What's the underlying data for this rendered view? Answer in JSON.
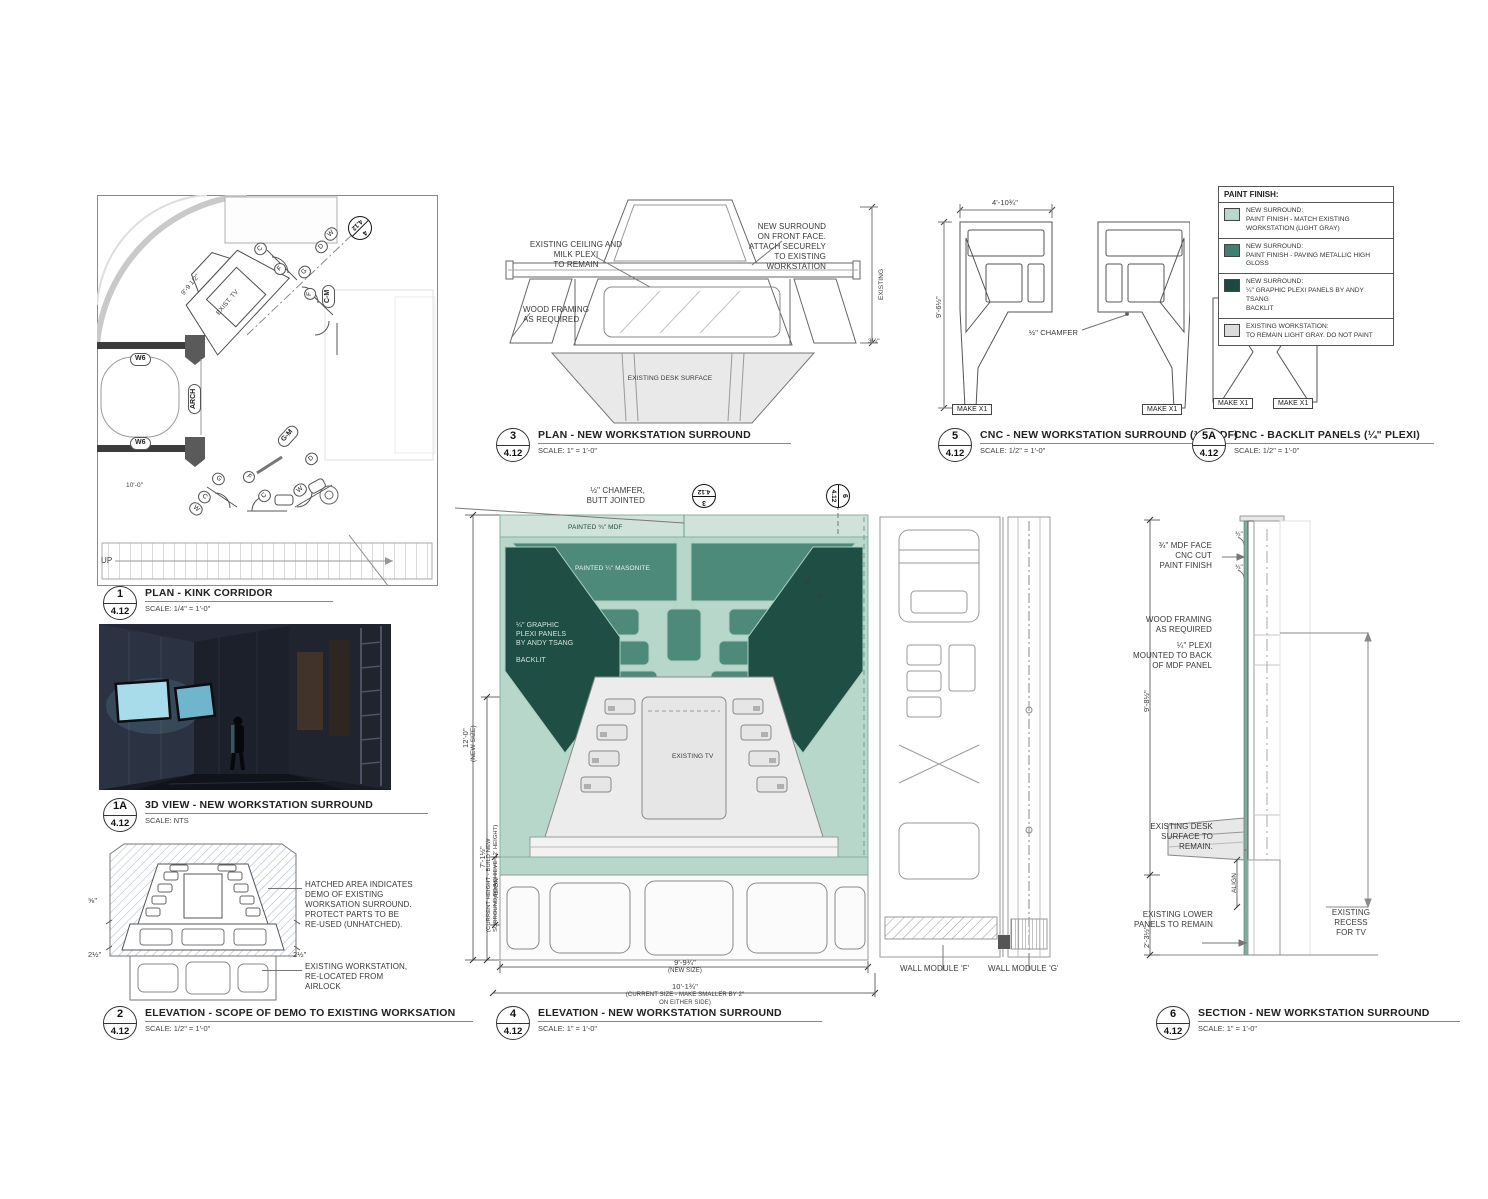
{
  "legend": {
    "title": "PAINT FINISH:",
    "items": [
      {
        "color": "#b9d8cd",
        "text": "NEW SURROUND:\nPAINT FINISH - MATCH EXISTING WORKSTATION (LIGHT GRAY)"
      },
      {
        "color": "#3f8070",
        "text": "NEW SURROUND:\nPAINT FINISH - PAVING METALLIC HIGH GLOSS"
      },
      {
        "color": "#1d4a40",
        "text": "NEW SURROUND:\n¼\" GRAPHIC PLEXI PANELS BY ANDY TSANG\nBACKLIT"
      },
      {
        "color": "#dcdcdc",
        "text": "EXISTING WORKSTATION:\nTO REMAIN LIGHT GRAY. DO NOT PAINT"
      }
    ]
  },
  "titles": {
    "d1": {
      "num": "1",
      "sheet": "4.12",
      "title": "PLAN - KINK CORRIDOR",
      "scale": "SCALE: 1/4\" = 1'-0\""
    },
    "d1a": {
      "num": "1A",
      "sheet": "4.12",
      "title": "3D VIEW - NEW WORKSTATION SURROUND",
      "scale": "SCALE: NTS"
    },
    "d2": {
      "num": "2",
      "sheet": "4.12",
      "title": "ELEVATION - SCOPE OF DEMO TO EXISTING WORKSATION",
      "scale": "SCALE: 1/2\" = 1'-0\""
    },
    "d3": {
      "num": "3",
      "sheet": "4.12",
      "title": "PLAN - NEW WORKSTATION SURROUND",
      "scale": "SCALE: 1\" = 1'-0\""
    },
    "d4": {
      "num": "4",
      "sheet": "4.12",
      "title": "ELEVATION - NEW WORKSTATION SURROUND",
      "scale": "SCALE: 1\" = 1'-0\""
    },
    "d5": {
      "num": "5",
      "sheet": "4.12",
      "title": "CNC - NEW WORKSTATION SURROUND (¾\" MDF)",
      "scale": "SCALE: 1/2\" = 1'-0\""
    },
    "d5a": {
      "num": "5A",
      "sheet": "4.12",
      "title": "CNC - BACKLIT PANELS (¼\" PLEXI)",
      "scale": "SCALE: 1/2\" = 1'-0\""
    },
    "d6": {
      "num": "6",
      "sheet": "4.12",
      "title": "SECTION - NEW WORKSTATION SURROUND",
      "scale": "SCALE: 1\" = 1'-0\""
    }
  },
  "plan1": {
    "w6a": "W6",
    "w6b": "W6",
    "arch": "ARCH",
    "cm": "C-M",
    "gm": "G-M",
    "tv": "EXIST. TV",
    "up": "UP",
    "dim_diag": "9'-9 1/2\"",
    "dim_left": "10'-0\"",
    "marker_num": "4",
    "marker_sheet": "4.12",
    "ovals": [
      "C",
      "F",
      "G",
      "D",
      "W",
      "F",
      "G",
      "F",
      "C",
      "W",
      "C",
      "W",
      "D"
    ]
  },
  "demo2": {
    "note_hatch": "HATCHED AREA INDICATES\nDEMO OF EXISTING\nWORKSATION SURROUND.\nPROTECT PARTS TO BE\nRE-USED (UNHATCHED).",
    "note_existing": "EXISTING WORKSTATION,\nRE-LOCATED FROM AIRLOCK",
    "dim_a": "⅝\"",
    "dim_b": "2½\"",
    "dim_c": "2½\""
  },
  "plan3": {
    "note_ceiling": "EXISTING CEILING AND MILK PLEXI\nTO REMAIN",
    "note_surround": "NEW SURROUND\nON FRONT FACE.\nATTACH SECURELY\nTO EXISTING\nWORKSTATION",
    "note_framing": "WOOD FRAMING\nAS REQUIRED",
    "label_desk": "EXISTING DESK SURFACE",
    "dim_existing": "EXISTING",
    "dim_small": "3¼\""
  },
  "elev4": {
    "note_chamfer": "½\" CHAMFER,\nBUTT JOINTED",
    "marker_top_num": "3",
    "marker_top_sheet": "4.12",
    "marker_right_num": "6",
    "marker_right_sheet": "4.12",
    "label_mdf": "PAINTED ¾\" MDF",
    "label_masonite": "PAINTED ¼\" MASONITE",
    "label_plexi": "¼\" GRAPHIC\nPLEXI PANELS\nBY ANDY TSANG\n\nBACKLIT",
    "label_tv": "EXISTING TV",
    "dim_h_new": "12'-0\"",
    "dim_h_new_sub": "(NEW SIZE)",
    "dim_h_cur": "7'-1½\"",
    "dim_h_cur_sub": "(CURRENT HEIGHT - BUILD NEW\nSURROUND TO ACHIEVE 12' HEIGHT)",
    "align": "ALIGN",
    "dim_sm_a": "⅝\"",
    "dim_sm_b": "⅝\"",
    "dim_w_new": "9'-9¾\"",
    "dim_w_new_sub": "(NEW SIZE)",
    "dim_w_cur": "10'-1¾\"",
    "dim_w_cur_sub": "(CURRENT SIZE - MAKE SMALLER BY 2\"\nON EITHER SIDE)",
    "module_f": "WALL MODULE 'F'",
    "module_g": "WALL MODULE 'G'"
  },
  "cnc5": {
    "dim_w": "4'-10¾\"",
    "dim_h": "9'-6½\"",
    "chamfer": "½\" CHAMFER",
    "make_a": "MAKE X1",
    "make_b": "MAKE X1"
  },
  "cnc5a": {
    "make_a": "MAKE X1",
    "make_b": "MAKE X1"
  },
  "sect6": {
    "note_mdf": "¾\" MDF FACE\nCNC CUT\nPAINT FINISH",
    "dim_a": "¾\"",
    "dim_b": "¾\"",
    "note_framing": "WOOD FRAMING\nAS REQUIRED",
    "note_plexi": "¼\" PLEXI\nMOUNTED TO BACK\nOF MDF PANEL",
    "note_desk": "EXISTING DESK\nSURFACE TO REMAIN.",
    "align": "ALIGN",
    "note_lower": "EXISTING LOWER\nPANELS TO REMAIN",
    "note_recess": "EXISTING\nRECESS\nFOR TV",
    "dim_upper": "9'-8½\"",
    "dim_lower": "2'-3½\""
  }
}
